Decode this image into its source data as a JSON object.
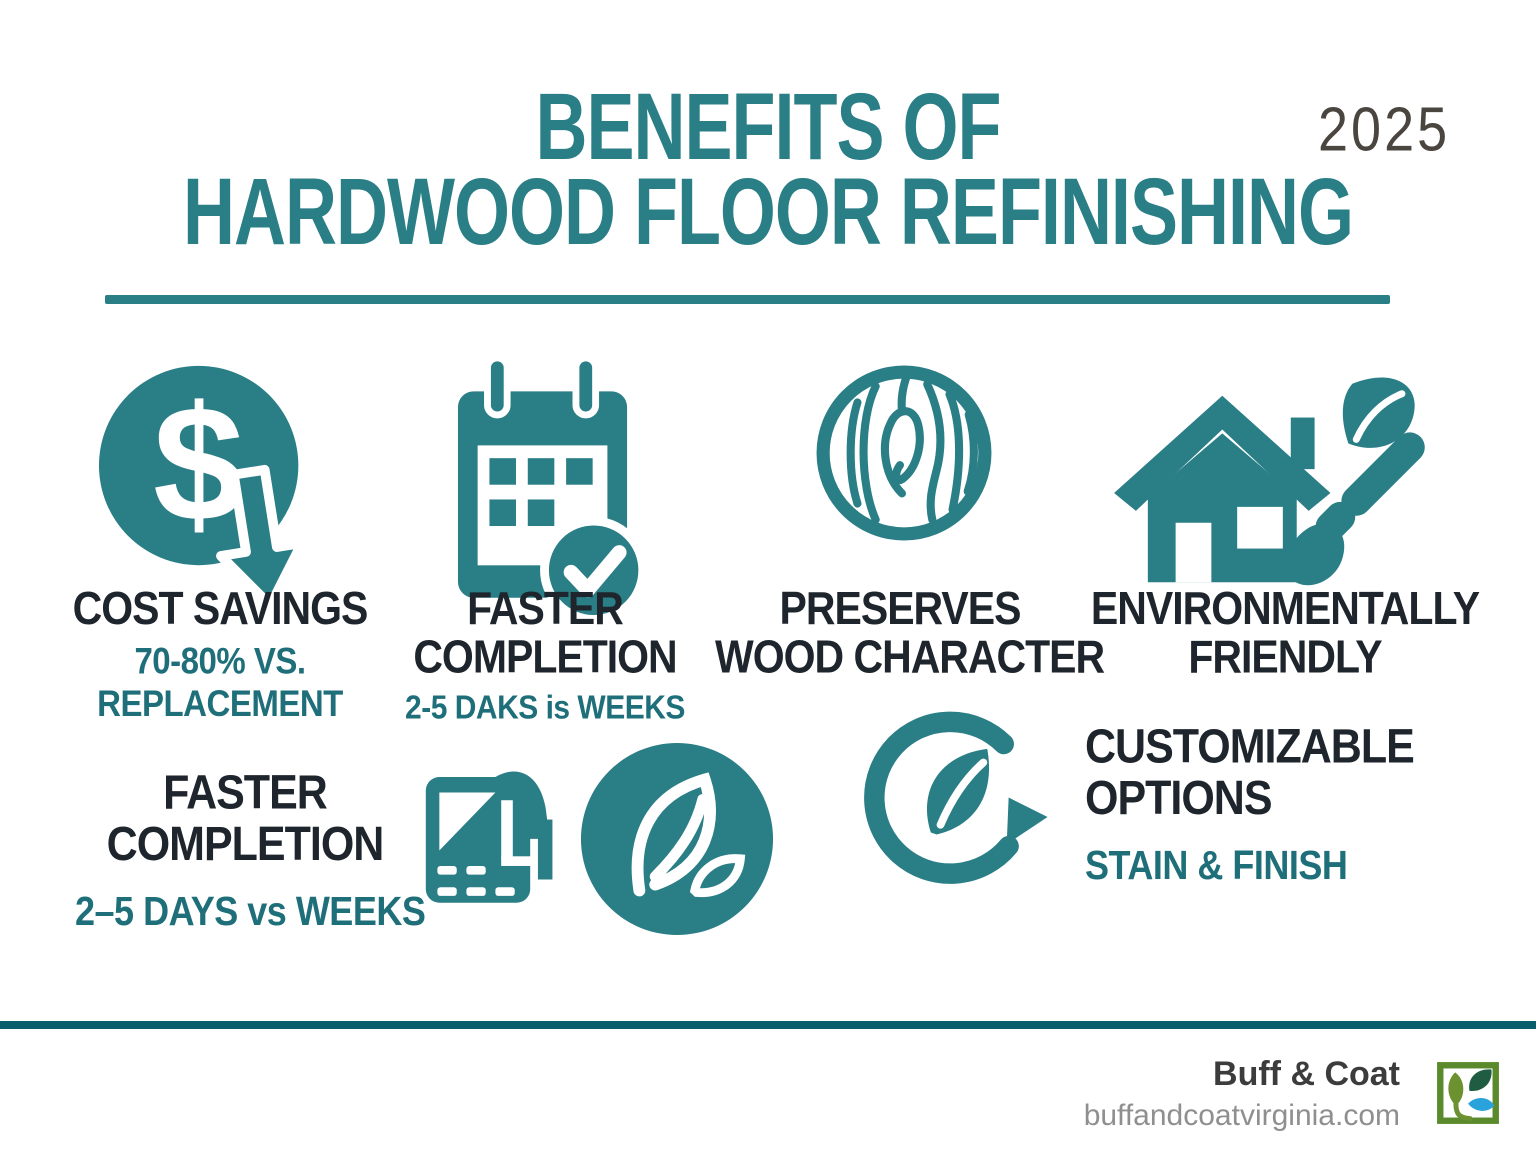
{
  "header": {
    "title_line1": "BENEFITS OF",
    "title_line2": "HARDWOOD FLOOR REFINISHING",
    "year": "2025"
  },
  "benefits": {
    "row1": [
      {
        "icon": "cost-savings-icon",
        "title": "COST SAVINGS",
        "subtitle_line1": "70-80% VS.",
        "subtitle_line2": "REPLACEMENT"
      },
      {
        "icon": "calendar-check-icon",
        "title_line1": "FASTER",
        "title_line2": "COMPLETION",
        "subtitle": "2-5 DAKS is WEEKS"
      },
      {
        "icon": "wood-grain-icon",
        "title_line1": "PRESERVES",
        "title_line2": "WOOD CHARACTER"
      },
      {
        "icon": "eco-home-paintbrush-icon",
        "title_line1": "ENVIRONMENTALLY",
        "title_line2": "FRIENDLY"
      }
    ],
    "row2": {
      "faster_completion": {
        "title_line1": "FASTER",
        "title_line2": "COMPLETION",
        "subtitle": "2–5 DAYS vs WEEKS"
      },
      "decorative_icons": [
        "floor-install-icon",
        "eco-leaf-circle-icon",
        "leaf-refresh-icon"
      ],
      "customizable": {
        "title_line1": "CUSTOMIZABLE",
        "title_line2": "OPTIONS",
        "subtitle": "STAIN & FINISH"
      }
    }
  },
  "footer": {
    "brand": "Buff & Coat",
    "website": "buffandcoatvirginia.com",
    "logo": "buff-and-coat-logo"
  },
  "colors": {
    "icon_teal": "#2A7E86",
    "text_teal": "#1F6F7A",
    "text_dark": "#1E252C",
    "year_gray": "#4B4540",
    "footer_line": "#0A5E6C",
    "brand_gray": "#3C3C3C",
    "website_gray": "#8F8F8F",
    "logo_frame_green": "#5B8A2D",
    "logo_olive": "#6B9130",
    "logo_dark_green": "#1F5C41",
    "logo_blue": "#2AA2DB"
  }
}
